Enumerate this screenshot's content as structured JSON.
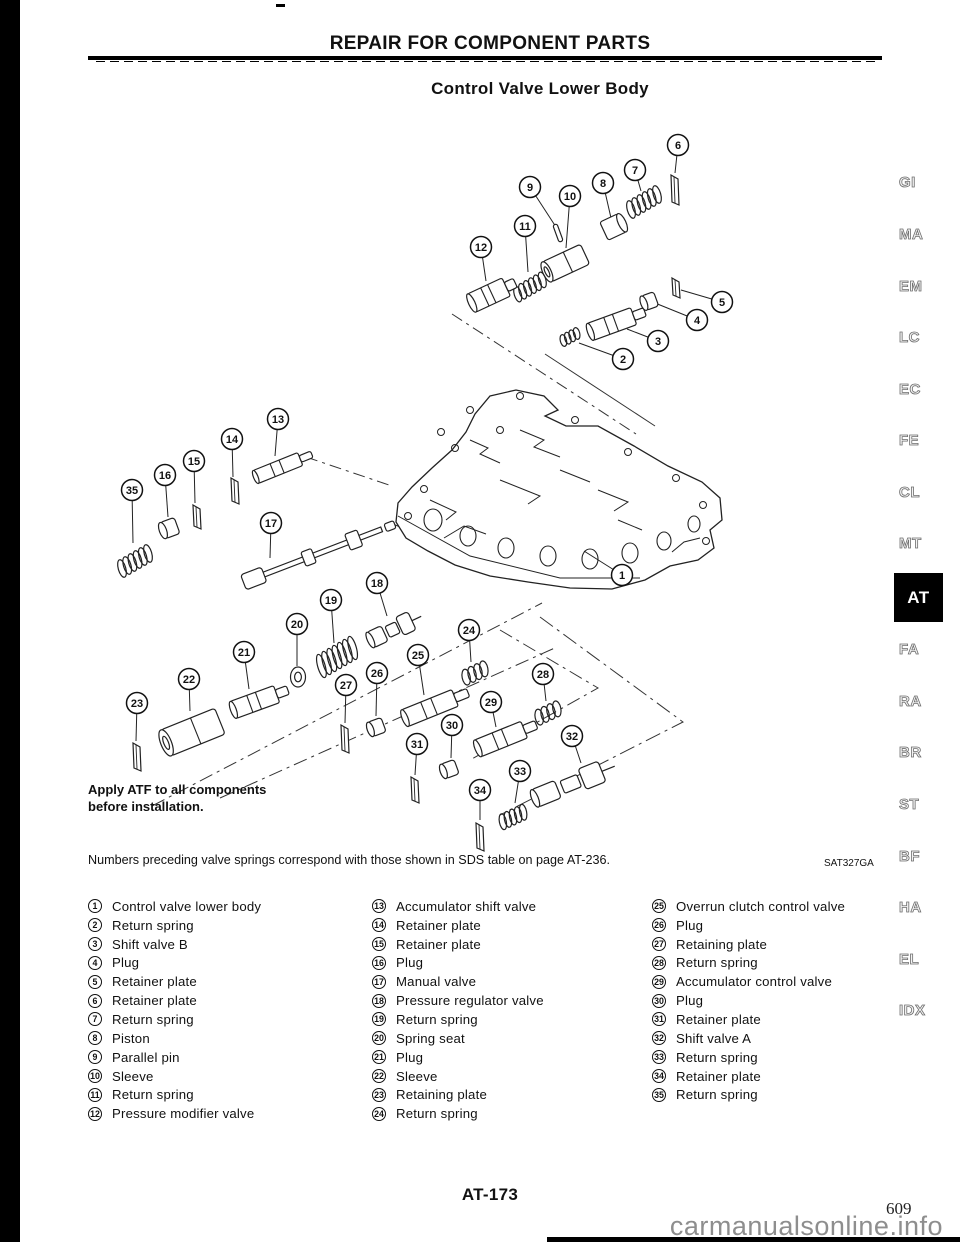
{
  "page": {
    "header": "REPAIR FOR COMPONENT PARTS",
    "title": "Control Valve Lower Body",
    "note_line1": "Apply ATF to all components",
    "note_line2": "before installation.",
    "footnote": "Numbers preceding valve springs correspond with those shown in SDS table on page AT-236.",
    "figure_code": "SAT327GA",
    "page_number": "AT-173",
    "printed_page_number": "609",
    "watermark": "carmanualsonline.info"
  },
  "colors": {
    "ink": "#111111",
    "line_art": "#222222",
    "tab_gray": "#8d8d8d",
    "active_tab_bg": "#000000",
    "watermark_gray": "#8e8e8e"
  },
  "sidebar_tabs": [
    {
      "label": "GI",
      "top": 174,
      "active": false
    },
    {
      "label": "MA",
      "top": 226,
      "active": false
    },
    {
      "label": "EM",
      "top": 278,
      "active": false
    },
    {
      "label": "LC",
      "top": 329,
      "active": false
    },
    {
      "label": "EC",
      "top": 381,
      "active": false
    },
    {
      "label": "FE",
      "top": 432,
      "active": false
    },
    {
      "label": "CL",
      "top": 484,
      "active": false
    },
    {
      "label": "MT",
      "top": 535,
      "active": false
    },
    {
      "label": "AT",
      "top": 573,
      "active": true
    },
    {
      "label": "FA",
      "top": 641,
      "active": false
    },
    {
      "label": "RA",
      "top": 693,
      "active": false
    },
    {
      "label": "BR",
      "top": 744,
      "active": false
    },
    {
      "label": "ST",
      "top": 796,
      "active": false
    },
    {
      "label": "BF",
      "top": 848,
      "active": false
    },
    {
      "label": "HA",
      "top": 899,
      "active": false
    },
    {
      "label": "EL",
      "top": 951,
      "active": false
    },
    {
      "label": "IDX",
      "top": 1002,
      "active": false
    }
  ],
  "parts_list": {
    "columns": [
      [
        {
          "num": "1",
          "label": "Control valve lower body"
        },
        {
          "num": "2",
          "label": "Return spring"
        },
        {
          "num": "3",
          "label": "Shift valve B"
        },
        {
          "num": "4",
          "label": "Plug"
        },
        {
          "num": "5",
          "label": "Retainer plate"
        },
        {
          "num": "6",
          "label": "Retainer plate"
        },
        {
          "num": "7",
          "label": "Return spring"
        },
        {
          "num": "8",
          "label": "Piston"
        },
        {
          "num": "9",
          "label": "Parallel pin"
        },
        {
          "num": "10",
          "label": "Sleeve"
        },
        {
          "num": "11",
          "label": "Return spring"
        },
        {
          "num": "12",
          "label": "Pressure modifier valve"
        }
      ],
      [
        {
          "num": "13",
          "label": "Accumulator shift valve"
        },
        {
          "num": "14",
          "label": "Retainer plate"
        },
        {
          "num": "15",
          "label": "Retainer plate"
        },
        {
          "num": "16",
          "label": "Plug"
        },
        {
          "num": "17",
          "label": "Manual valve"
        },
        {
          "num": "18",
          "label": "Pressure regulator valve"
        },
        {
          "num": "19",
          "label": "Return spring"
        },
        {
          "num": "20",
          "label": "Spring seat"
        },
        {
          "num": "21",
          "label": "Plug"
        },
        {
          "num": "22",
          "label": "Sleeve"
        },
        {
          "num": "23",
          "label": "Retaining plate"
        },
        {
          "num": "24",
          "label": "Return spring"
        }
      ],
      [
        {
          "num": "25",
          "label": "Overrun clutch control valve"
        },
        {
          "num": "26",
          "label": "Plug"
        },
        {
          "num": "27",
          "label": "Retaining plate"
        },
        {
          "num": "28",
          "label": "Return spring"
        },
        {
          "num": "29",
          "label": "Accumulator control valve"
        },
        {
          "num": "30",
          "label": "Plug"
        },
        {
          "num": "31",
          "label": "Retainer plate"
        },
        {
          "num": "32",
          "label": "Shift valve A"
        },
        {
          "num": "33",
          "label": "Return spring"
        },
        {
          "num": "34",
          "label": "Retainer plate"
        },
        {
          "num": "35",
          "label": "Return spring"
        }
      ]
    ]
  },
  "diagram": {
    "callouts": [
      {
        "n": "1",
        "x": 622,
        "y": 575,
        "ax": 584,
        "ay": 551,
        "part": null
      },
      {
        "n": "2",
        "x": 623,
        "y": 359,
        "ax": 579,
        "ay": 343,
        "part": {
          "kind": "spring",
          "x": 570,
          "y": 337,
          "len": 20,
          "r": 6,
          "angle": -28
        }
      },
      {
        "n": "3",
        "x": 658,
        "y": 341,
        "ax": 627,
        "ay": 329,
        "part": {
          "kind": "valve",
          "x": 612,
          "y": 324,
          "len": 46,
          "r": 9,
          "angle": -20
        }
      },
      {
        "n": "4",
        "x": 697,
        "y": 320,
        "ax": 655,
        "ay": 303,
        "part": {
          "kind": "plug",
          "x": 650,
          "y": 301,
          "len": 13,
          "r": 8,
          "angle": -20
        }
      },
      {
        "n": "5",
        "x": 722,
        "y": 302,
        "ax": 681,
        "ay": 290,
        "part": {
          "kind": "plate",
          "x": 676,
          "y": 288,
          "h": 20
        }
      },
      {
        "n": "6",
        "x": 678,
        "y": 145,
        "ax": 675,
        "ay": 173,
        "part": {
          "kind": "plate",
          "x": 675,
          "y": 190,
          "h": 30
        }
      },
      {
        "n": "7",
        "x": 635,
        "y": 170,
        "ax": 641,
        "ay": 191,
        "part": {
          "kind": "spring",
          "x": 644,
          "y": 202,
          "len": 36,
          "r": 9,
          "angle": -30
        }
      },
      {
        "n": "8",
        "x": 603,
        "y": 183,
        "ax": 611,
        "ay": 218,
        "part": {
          "kind": "piston",
          "x": 613,
          "y": 227,
          "len": 20,
          "r": 10,
          "angle": -25
        }
      },
      {
        "n": "9",
        "x": 530,
        "y": 187,
        "ax": 556,
        "ay": 227,
        "part": {
          "kind": "pin",
          "x": 558,
          "y": 233,
          "len": 18,
          "r": 2.5,
          "angle": 70
        }
      },
      {
        "n": "10",
        "x": 570,
        "y": 196,
        "ax": 566,
        "ay": 248,
        "part": {
          "kind": "sleeve",
          "x": 566,
          "y": 263,
          "len": 42,
          "r": 11,
          "angle": -25
        }
      },
      {
        "n": "11",
        "x": 525,
        "y": 226,
        "ax": 528,
        "ay": 272,
        "part": {
          "kind": "spring",
          "x": 530,
          "y": 287,
          "len": 34,
          "r": 8,
          "angle": -30
        }
      },
      {
        "n": "12",
        "x": 481,
        "y": 247,
        "ax": 486,
        "ay": 281,
        "part": {
          "kind": "valve",
          "x": 489,
          "y": 295,
          "len": 38,
          "r": 10,
          "angle": -25
        }
      },
      {
        "n": "13",
        "x": 278,
        "y": 419,
        "ax": 275,
        "ay": 456,
        "part": {
          "kind": "valve",
          "x": 278,
          "y": 468,
          "len": 48,
          "r": 7,
          "angle": -22
        }
      },
      {
        "n": "14",
        "x": 232,
        "y": 439,
        "ax": 233,
        "ay": 477,
        "part": {
          "kind": "plate",
          "x": 235,
          "y": 491,
          "h": 26
        }
      },
      {
        "n": "15",
        "x": 194,
        "y": 461,
        "ax": 195,
        "ay": 503,
        "part": {
          "kind": "plate",
          "x": 197,
          "y": 517,
          "h": 24
        }
      },
      {
        "n": "16",
        "x": 165,
        "y": 475,
        "ax": 168,
        "ay": 517,
        "part": {
          "kind": "plug",
          "x": 170,
          "y": 528,
          "len": 15,
          "r": 9,
          "angle": -20
        }
      },
      {
        "n": "17",
        "x": 271,
        "y": 523,
        "ax": 270,
        "ay": 558,
        "part": {
          "kind": "rod",
          "x": 320,
          "y": 553,
          "len": 148,
          "r": 4,
          "angle": -21
        }
      },
      {
        "n": "18",
        "x": 377,
        "y": 583,
        "ax": 387,
        "ay": 616,
        "part": {
          "kind": "mvalve",
          "x": 394,
          "y": 629,
          "len": 52,
          "r": 10,
          "angle": -25
        }
      },
      {
        "n": "19",
        "x": 331,
        "y": 600,
        "ax": 334,
        "ay": 643,
        "part": {
          "kind": "spring",
          "x": 337,
          "y": 657,
          "len": 42,
          "r": 12,
          "angle": -30
        }
      },
      {
        "n": "20",
        "x": 297,
        "y": 624,
        "ax": 297,
        "ay": 666,
        "part": {
          "kind": "washer",
          "x": 298,
          "y": 677
        }
      },
      {
        "n": "21",
        "x": 244,
        "y": 652,
        "ax": 249,
        "ay": 689,
        "part": {
          "kind": "valve",
          "x": 255,
          "y": 702,
          "len": 46,
          "r": 9,
          "angle": -20
        }
      },
      {
        "n": "22",
        "x": 189,
        "y": 679,
        "ax": 190,
        "ay": 711,
        "part": {
          "kind": "sleeve",
          "x": 193,
          "y": 732,
          "len": 58,
          "r": 14,
          "angle": -22
        }
      },
      {
        "n": "23",
        "x": 137,
        "y": 703,
        "ax": 136,
        "ay": 741,
        "part": {
          "kind": "plate",
          "x": 137,
          "y": 757,
          "h": 28
        }
      },
      {
        "n": "24",
        "x": 469,
        "y": 630,
        "ax": 471,
        "ay": 662,
        "part": {
          "kind": "spring",
          "x": 475,
          "y": 673,
          "len": 26,
          "r": 8,
          "angle": -25
        }
      },
      {
        "n": "25",
        "x": 418,
        "y": 655,
        "ax": 424,
        "ay": 695,
        "part": {
          "kind": "valve",
          "x": 430,
          "y": 708,
          "len": 54,
          "r": 9,
          "angle": -22
        }
      },
      {
        "n": "26",
        "x": 377,
        "y": 673,
        "ax": 376,
        "ay": 716,
        "part": {
          "kind": "plug",
          "x": 377,
          "y": 727,
          "len": 14,
          "r": 8,
          "angle": -20
        }
      },
      {
        "n": "27",
        "x": 346,
        "y": 685,
        "ax": 345,
        "ay": 723,
        "part": {
          "kind": "plate",
          "x": 345,
          "y": 739,
          "h": 28
        }
      },
      {
        "n": "28",
        "x": 543,
        "y": 674,
        "ax": 546,
        "ay": 701,
        "part": {
          "kind": "spring",
          "x": 548,
          "y": 713,
          "len": 26,
          "r": 8,
          "angle": -25
        }
      },
      {
        "n": "29",
        "x": 491,
        "y": 702,
        "ax": 496,
        "ay": 727,
        "part": {
          "kind": "valve",
          "x": 501,
          "y": 739,
          "len": 50,
          "r": 9,
          "angle": -22
        }
      },
      {
        "n": "30",
        "x": 452,
        "y": 725,
        "ax": 451,
        "ay": 758,
        "part": {
          "kind": "plug",
          "x": 450,
          "y": 769,
          "len": 14,
          "r": 8,
          "angle": -20
        }
      },
      {
        "n": "31",
        "x": 417,
        "y": 744,
        "ax": 415,
        "ay": 775,
        "part": {
          "kind": "plate",
          "x": 415,
          "y": 790,
          "h": 26
        }
      },
      {
        "n": "32",
        "x": 572,
        "y": 736,
        "ax": 581,
        "ay": 763,
        "part": {
          "kind": "mvalve",
          "x": 573,
          "y": 783,
          "len": 82,
          "r": 11,
          "angle": -22
        }
      },
      {
        "n": "33",
        "x": 520,
        "y": 771,
        "ax": 515,
        "ay": 803,
        "part": {
          "kind": "spring",
          "x": 513,
          "y": 817,
          "len": 28,
          "r": 8,
          "angle": -25
        }
      },
      {
        "n": "34",
        "x": 480,
        "y": 790,
        "ax": 480,
        "ay": 820,
        "part": {
          "kind": "plate",
          "x": 480,
          "y": 837,
          "h": 28
        }
      },
      {
        "n": "35",
        "x": 132,
        "y": 490,
        "ax": 133,
        "ay": 543,
        "part": {
          "kind": "spring",
          "x": 135,
          "y": 561,
          "len": 36,
          "r": 9,
          "angle": -30
        }
      }
    ]
  }
}
